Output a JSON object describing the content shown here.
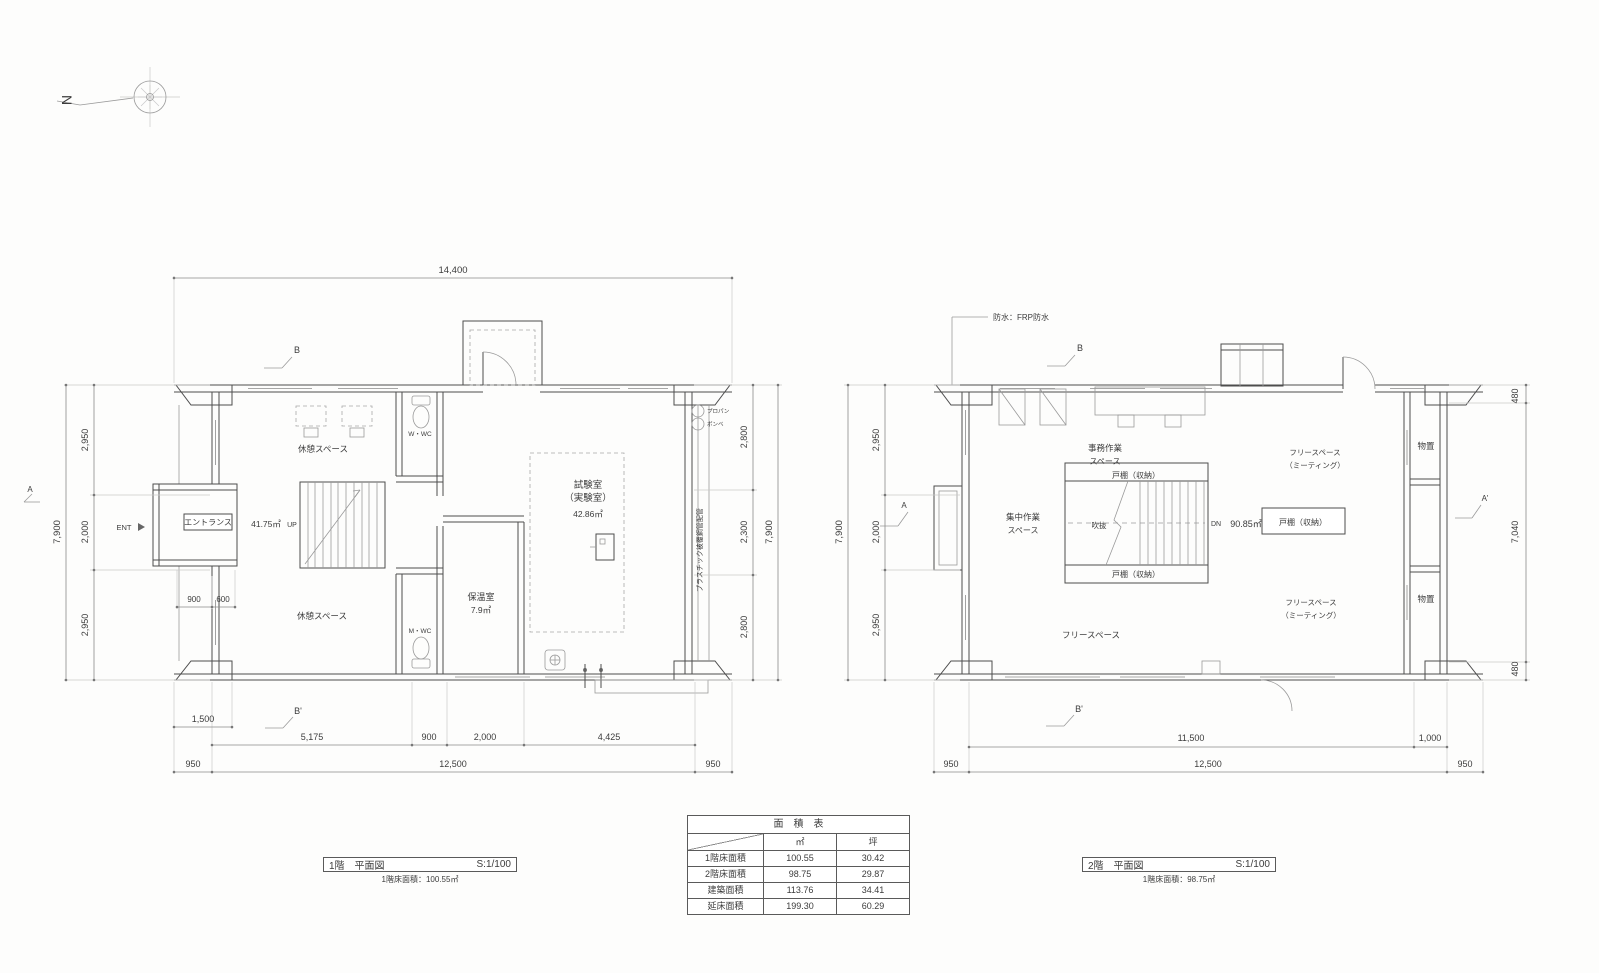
{
  "compass": {
    "north": "N"
  },
  "plan1f": {
    "title": "1階　平面図",
    "scale": "S:1/100",
    "subtitle": "1階床面積：100.55㎡",
    "marks": {
      "b": "B",
      "b_prime": "B'",
      "a": "A"
    },
    "dims": {
      "top": "14,400",
      "left_total": "7,900",
      "left_seg1": "2,950",
      "left_seg2": "2,000",
      "left_seg3": "2,950",
      "right_total": "7,900",
      "right_seg1": "2,800",
      "right_seg2": "2,300",
      "right_seg3": "2,800",
      "porch": "1,500",
      "bottom_seg1": "5,175",
      "bottom_seg2": "900",
      "bottom_seg3": "2,000",
      "bottom_seg4": "4,425",
      "bottom_eave_left": "950",
      "bottom_total": "12,500",
      "bottom_eave_right": "950",
      "entrance_seg1": "900",
      "entrance_seg2": "600"
    },
    "labels": {
      "ent": "ENT",
      "entrance": "エントランス",
      "floor_area": "41.75㎡",
      "up": "UP",
      "rest_top": "休憩スペース",
      "rest_bottom": "休憩スペース",
      "wc_w": "W・WC",
      "wc_m": "M・WC",
      "lab_line1": "試験室",
      "lab_line2": "（実験室）",
      "lab_area": "42.86㎡",
      "warm_room": "保温室",
      "warm_area": "7.9㎡",
      "propane1": "プロパン",
      "propane2": "ボンベ",
      "pipe_note": "プラスチック被覆鋼管配管"
    }
  },
  "plan2f": {
    "title": "2階　平面図",
    "scale": "S:1/100",
    "subtitle": "1階床面積：98.75㎡",
    "note_waterproof": "防水：FRP防水",
    "marks": {
      "b": "B",
      "b_prime": "B'",
      "a": "A",
      "a_prime": "A'"
    },
    "dims": {
      "left_total": "7,900",
      "left_seg1": "2,950",
      "left_seg2": "2,000",
      "left_seg3": "2,950",
      "right_seg1": "480",
      "right_seg2": "7,040",
      "right_seg3": "480",
      "bottom_seg1": "11,500",
      "bottom_seg2": "1,000",
      "bottom_eave_left": "950",
      "bottom_total": "12,500",
      "bottom_eave_right": "950"
    },
    "labels": {
      "office_line1": "事務作業",
      "office_line2": "スペース",
      "free_meeting_top_line1": "フリースペース",
      "free_meeting_top_line2": "（ミーティング）",
      "free_meeting_bottom_line1": "フリースペース",
      "free_meeting_bottom_line2": "（ミーティング）",
      "storage_top": "物置",
      "storage_bottom": "物置",
      "cupboard_top": "戸棚（収納）",
      "cupboard_bottom": "戸棚（収納）",
      "cupboard_right": "戸棚（収納）",
      "focus_line1": "集中作業",
      "focus_line2": "スペース",
      "void": "吹抜",
      "dn": "DN",
      "floor_area": "90.85㎡",
      "free_space": "フリースペース"
    }
  },
  "area_table": {
    "title": "面　積　表",
    "col_m2": "㎡",
    "col_tsubo": "坪",
    "rows": [
      {
        "label": "1階床面積",
        "m2": "100.55",
        "tsubo": "30.42"
      },
      {
        "label": "2階床面積",
        "m2": "98.75",
        "tsubo": "29.87"
      },
      {
        "label": "建築面積",
        "m2": "113.76",
        "tsubo": "34.41"
      },
      {
        "label": "延床面積",
        "m2": "199.30",
        "tsubo": "60.29"
      }
    ]
  }
}
